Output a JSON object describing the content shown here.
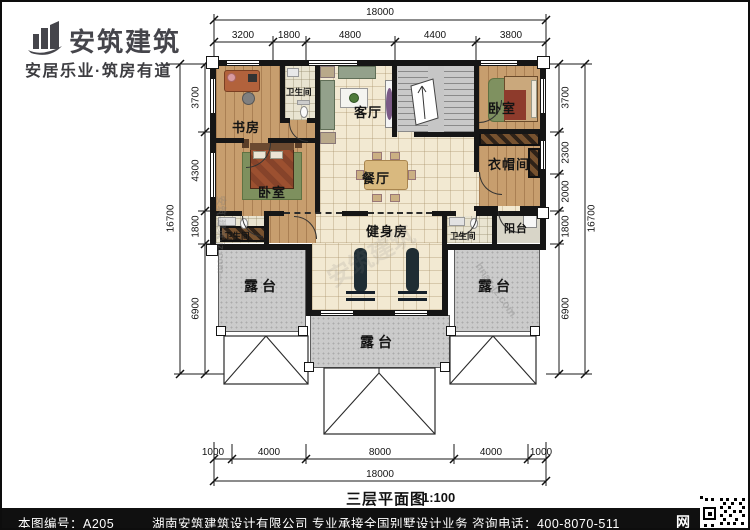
{
  "brand": {
    "name": "安筑建筑",
    "tagline": "安居乐业·筑房有道"
  },
  "plan_title": {
    "text": "三层平面图",
    "scale": "1:100"
  },
  "rooms": {
    "study": "书房",
    "bath_top": "卫生间",
    "living": "客厅",
    "bedroom_right": "卧室",
    "bedroom_left": "卧室",
    "cloakroom": "衣帽间",
    "dining": "餐厅",
    "balcony": "阳台",
    "gym": "健身房",
    "bath_bottom_left": "卫生间",
    "bath_bottom_right": "卫生间",
    "terrace_left": "露台",
    "terrace_right": "露台",
    "terrace_bottom": "露台"
  },
  "dims": {
    "top_total": "18000",
    "top_segments": [
      "3200",
      "1800",
      "4800",
      "4400",
      "3800"
    ],
    "left_total": "16700",
    "left_segments": [
      "3700",
      "4300",
      "1800",
      "6900"
    ],
    "right_segments": [
      "3700",
      "2300",
      "2000",
      "1800",
      "6900"
    ],
    "right_total": "16700",
    "bottom_segments": [
      "1000",
      "4000",
      "8000",
      "4000",
      "1000"
    ],
    "bottom_total": "18000"
  },
  "footer": {
    "sheet_label": "本图编号：A205",
    "company_line": "湖南安筑建筑设计有限公司  专业承接全国别墅设计业务  咨询电话：400-8070-511",
    "web_glyph": "网"
  },
  "watermarks": [
    "安筑-建筑·jz.com—",
    "安筑建筑",
    "hnaz-jz.com"
  ]
}
